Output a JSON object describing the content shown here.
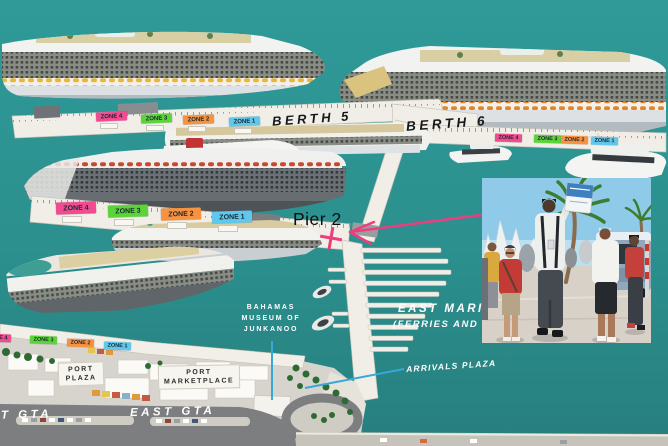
{
  "labels": {
    "berth_5": "BERTH 5",
    "berth_6": "BERTH 6",
    "pier_2": "Pier 2",
    "east_marina_line1": "EAST MARI",
    "east_marina_line2": "(FERRIES AND",
    "arrivals_plaza": "ARRIVALS PLAZA",
    "museum_line1": "BAHAMAS",
    "museum_line2": "MUSEUM OF",
    "museum_line3": "JUNKANOO",
    "port_plaza_line1": "PORT",
    "port_plaza_line2": "PLAZA",
    "port_marketplace_line1": "PORT",
    "port_marketplace_line2": "MARKETPLACE",
    "east_gta": "EAST GTA",
    "gta_partial": "T GTA"
  },
  "zones": {
    "berth5_pier": [
      "ZONE 4",
      "ZONE 3",
      "ZONE 2",
      "ZONE 1"
    ],
    "berth6_pier": [
      "ZONE 4",
      "ZONE 3",
      "ZONE 2",
      "ZONE 1"
    ],
    "pier2_quay": [
      "ZONE 4",
      "ZONE 3",
      "ZONE 2",
      "ZONE 1"
    ],
    "waterfront": [
      "ZONE 4",
      "ZONE 3",
      "ZONE 2",
      "ZONE 1"
    ]
  },
  "colors": {
    "water": "#2c918f",
    "zone_pink": "#f24b92",
    "zone_green": "#5bd43a",
    "zone_orange": "#f79340",
    "zone_blue": "#5fc8ec",
    "pier_white": "#f0eee7",
    "land": "#d7d4cd",
    "road": "#7d7e7f",
    "arrow_pink": "#ee3d7c",
    "callout_blue": "#38a8d9",
    "label_white": "#ffffff",
    "label_black": "#16181a"
  }
}
